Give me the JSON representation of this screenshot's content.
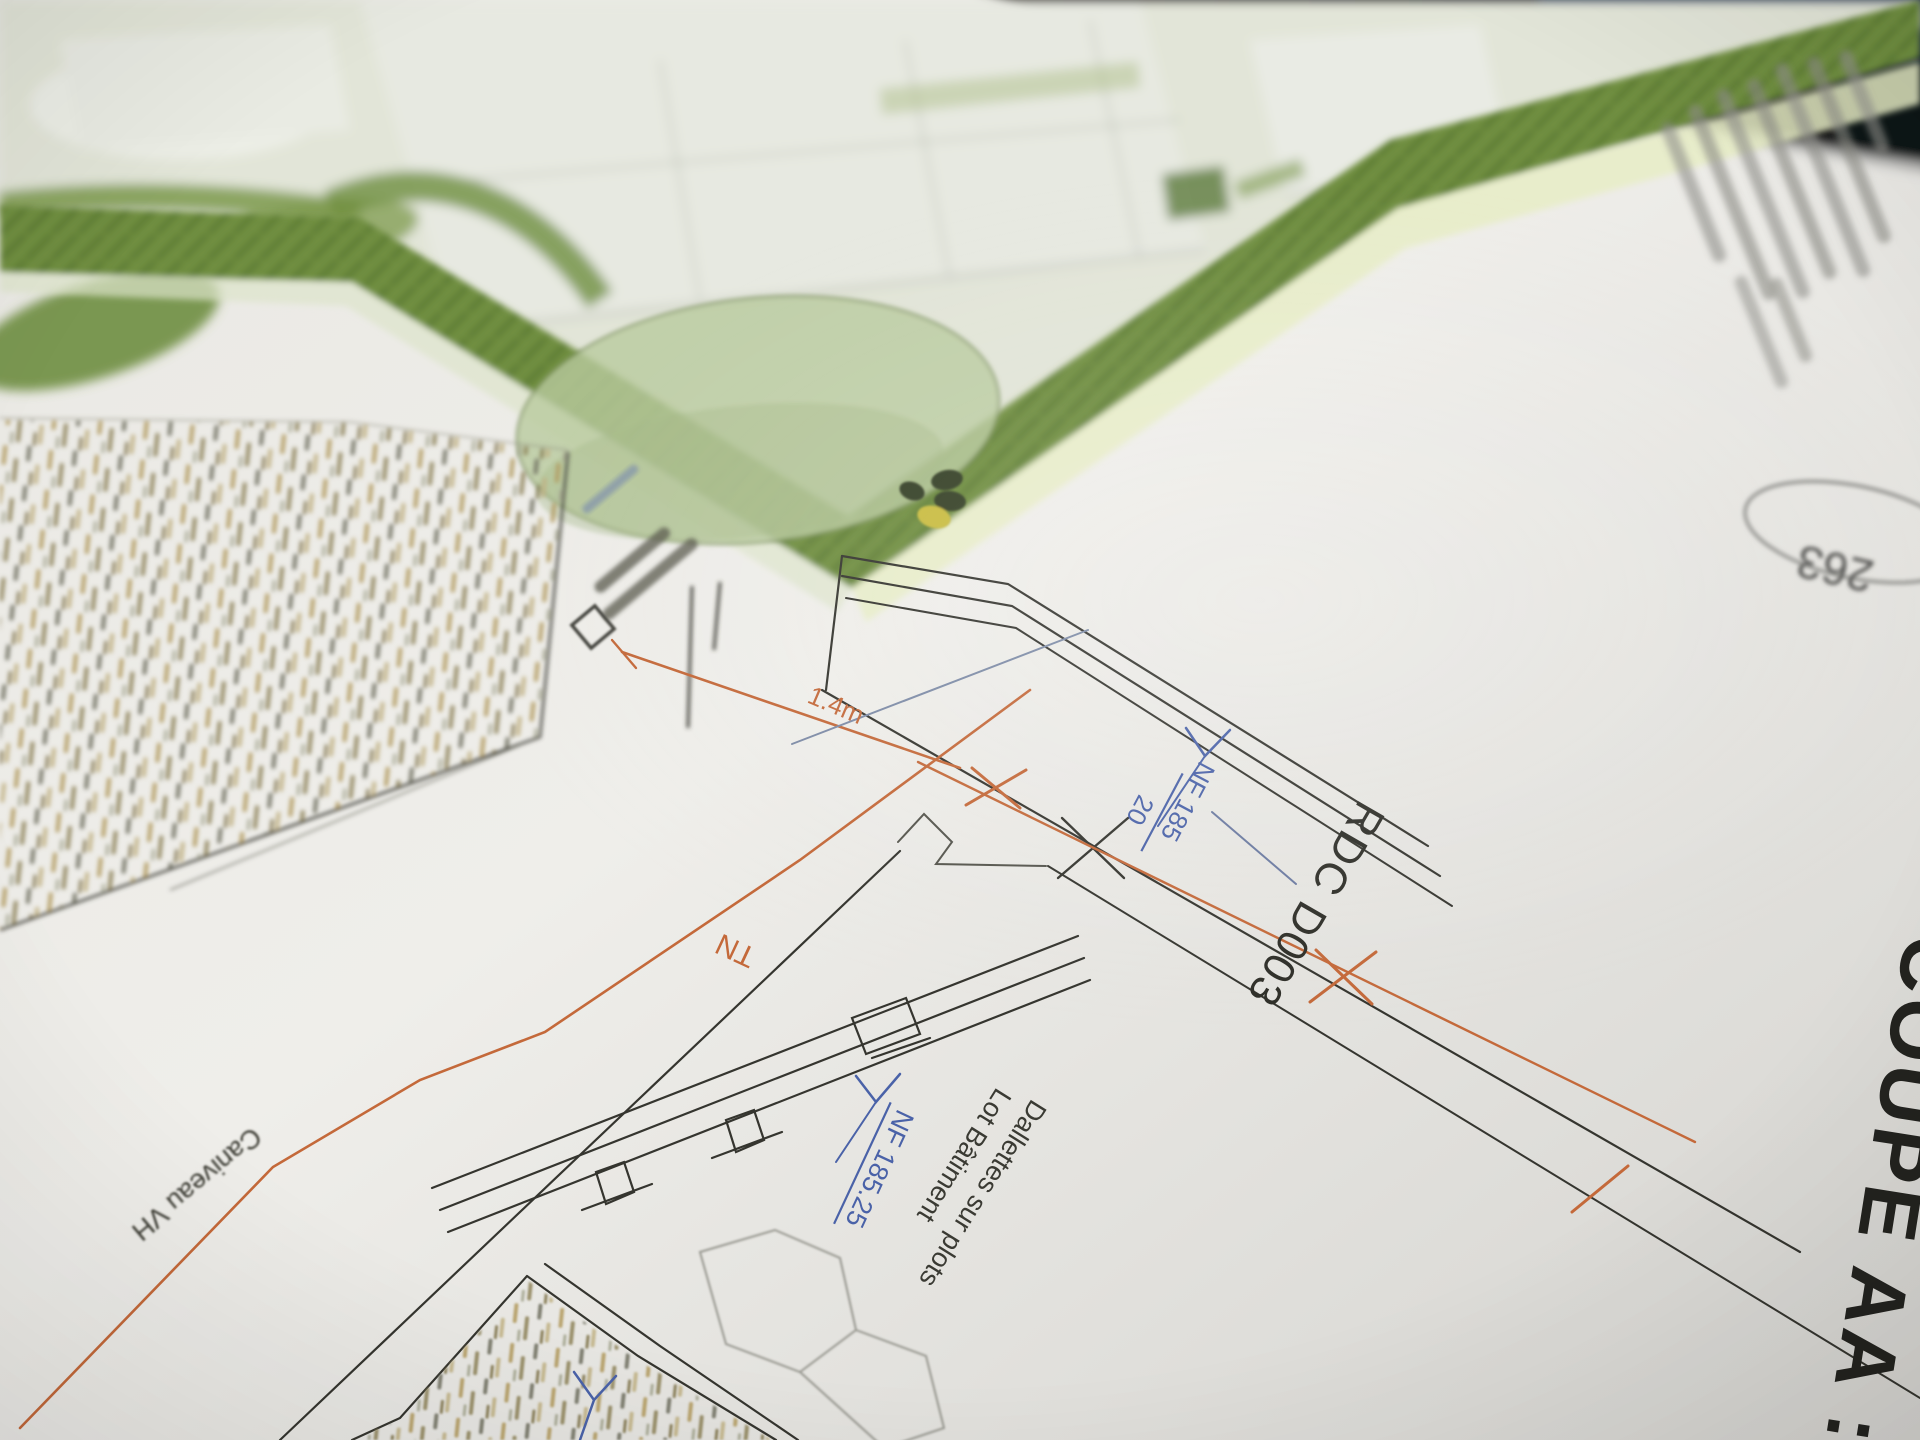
{
  "annotations": {
    "section_title": "COUPE AA :",
    "room_label": "RDC D003",
    "level_wall": {
      "name": "NF 185",
      "decimals": "20"
    },
    "level_slab": "NF 185.25",
    "terrain_label": "TN",
    "dimension_label": "1.4m",
    "slab_note_line1": "Dallettes sur plots",
    "slab_note_line2": "Lot Bâtiment",
    "channel_label": "Caniveau VH",
    "stamp_number": "263"
  },
  "colors": {
    "paper": "#eceae6",
    "hedge_green": "#6f8e40",
    "tree_green": "#bacb9f",
    "annotation_blue": "#4a62a8",
    "terrain_orange": "#c4693a",
    "line_black": "#35352f",
    "background_dark": "#1c1d22",
    "navy_object": "#1d2944"
  }
}
